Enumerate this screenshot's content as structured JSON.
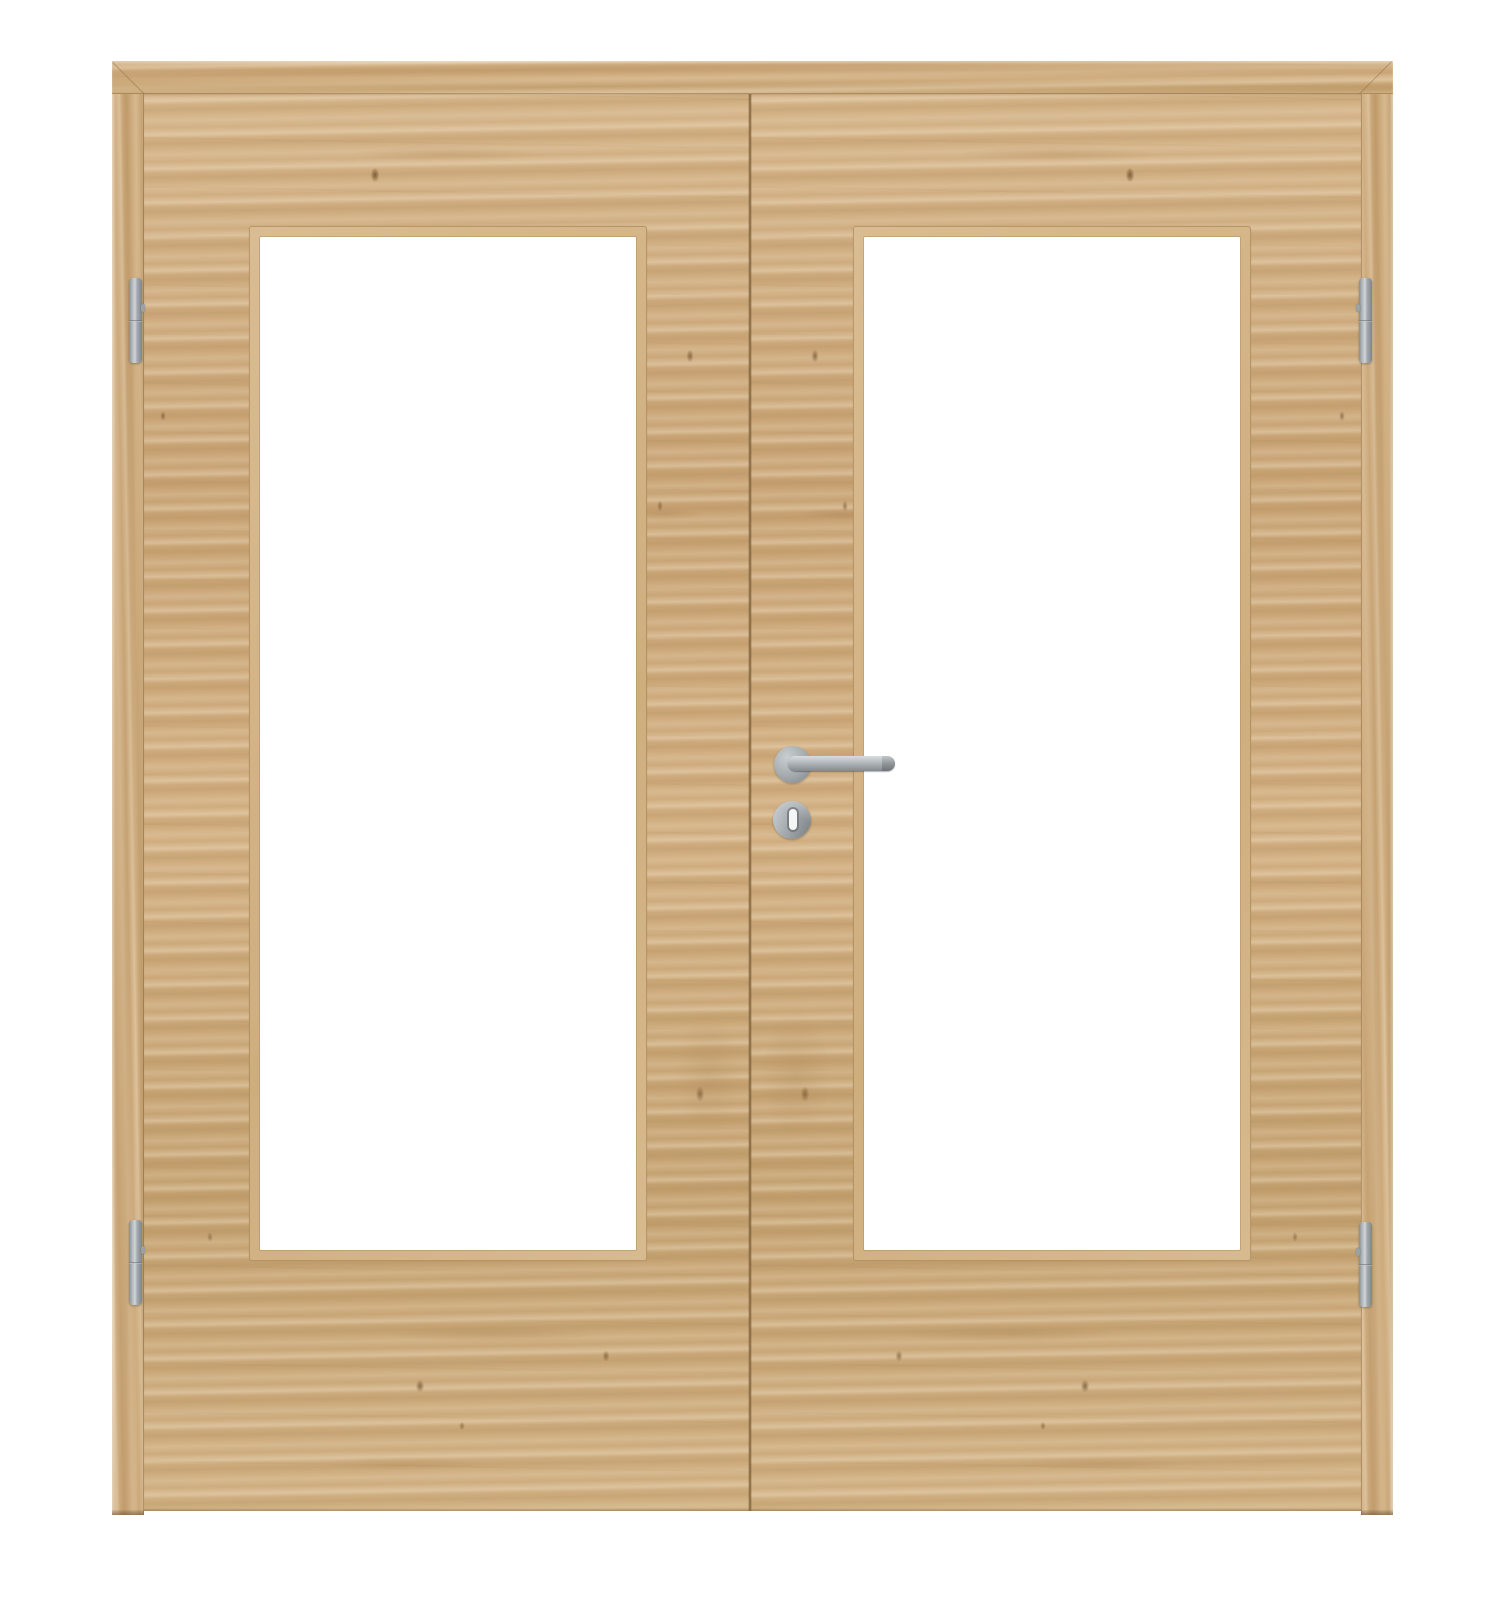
{
  "meta": {
    "type": "product-photo",
    "subject": "Double interior door with frame, light oak wood decor, glass cutouts and stainless steel hardware",
    "visible_text": "none"
  },
  "labels": {
    "stage": "Product photo of a double glazed interior door",
    "unit": "Double door with surrounding frame",
    "frame_head": "Door frame head",
    "frame_left": "Door frame left jamb",
    "frame_right": "Door frame right jamb",
    "left_leaf": "Left door leaf",
    "right_leaf": "Right door leaf",
    "left_glass": "Left glass cutout with wood bevel trim",
    "right_glass": "Right glass cutout with wood bevel trim",
    "gap": "Meeting gap between the two leaves",
    "handle_rose": "Round handle rose",
    "handle": "Stainless steel lever handle",
    "escutcheon": "Round keyhole escutcheon",
    "keyhole": "Keyhole slot",
    "hinge_tl": "Top left hinge",
    "hinge_bl": "Bottom left hinge",
    "hinge_tr": "Top right hinge",
    "hinge_br": "Bottom right hinge"
  },
  "colors": {
    "background": "#ffffff",
    "wood_base": "#ccaa7c",
    "wood_light": "#ddc299",
    "wood_dark": "#b28c5d",
    "frame_base": "#c9a576",
    "seam": "#7e6039",
    "bevel": "#d9bc92",
    "glass": "#ffffff",
    "metal_light": "#d0d5d7",
    "metal_mid": "#a4aaae",
    "metal_dark": "#7f8589"
  }
}
